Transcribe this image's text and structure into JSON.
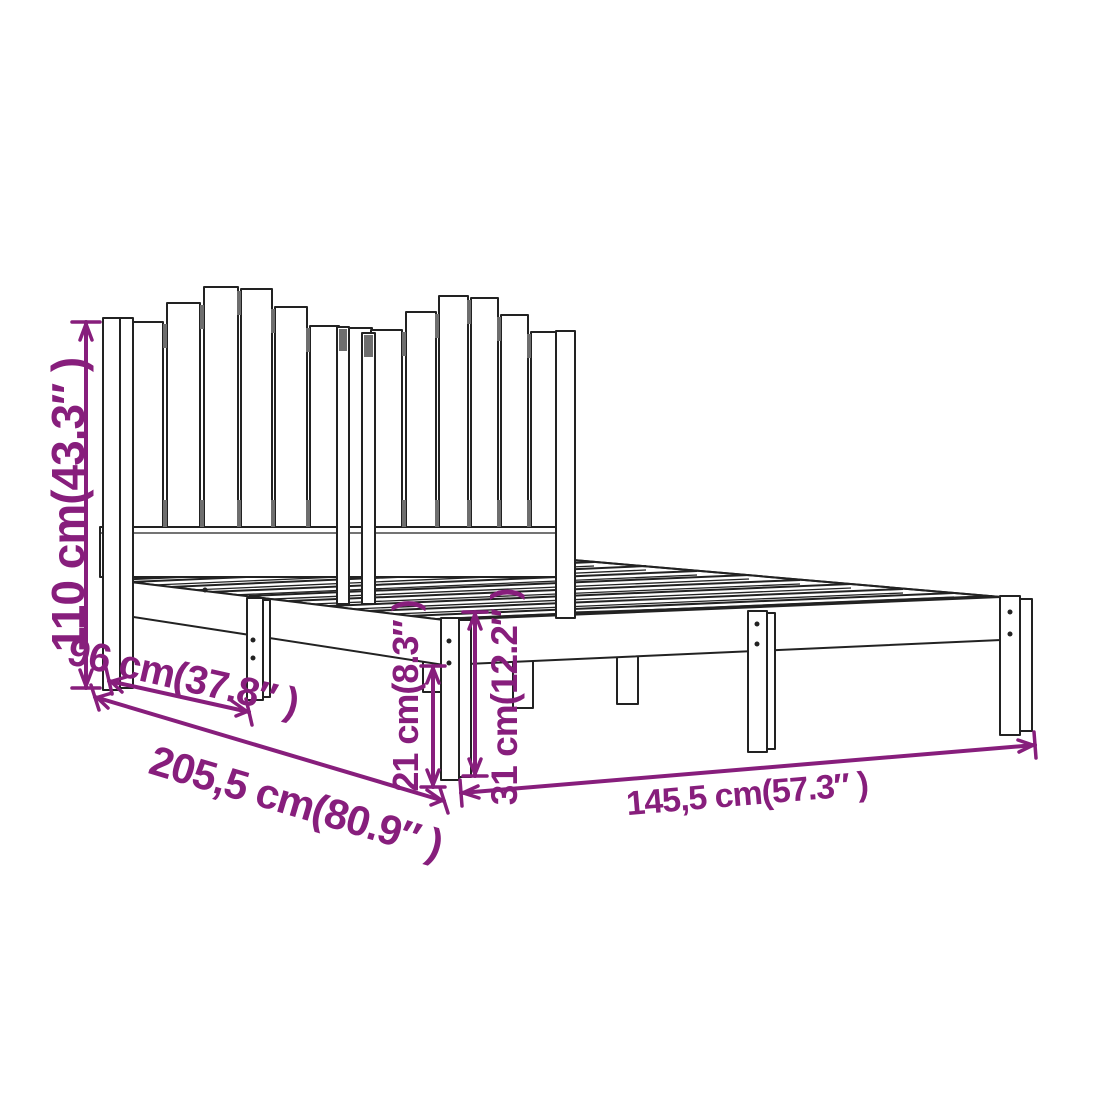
{
  "diagram": {
    "type": "product-dimension-diagram",
    "subject": "bed frame with slatted headboard",
    "dimensions": {
      "dim_110": {
        "value_cm": "110",
        "value_inch": "43.3",
        "label": "110 cm(43.3″ )"
      },
      "dim_96": {
        "value_cm": "96",
        "value_inch": "37.8",
        "label": "96 cm(37.8″ )"
      },
      "dim_205_5": {
        "value_cm": "205,5",
        "value_inch": "80.9",
        "label": "205,5 cm(80.9″ )"
      },
      "dim_145_5": {
        "value_cm": "145,5",
        "value_inch": "57.3",
        "label": "145,5 cm(57.3″ )"
      },
      "dim_21": {
        "value_cm": "21",
        "value_inch": "8.3",
        "label": "21 cm(8.3″ )"
      },
      "dim_31": {
        "value_cm": "31",
        "value_inch": "12.2",
        "label": "31 cm(12.2″ )"
      }
    },
    "colors": {
      "dimension_accent": "#871E7C",
      "line": "#222222",
      "background": "#ffffff",
      "slat_gap_shadow": "#6e6e6e"
    }
  }
}
